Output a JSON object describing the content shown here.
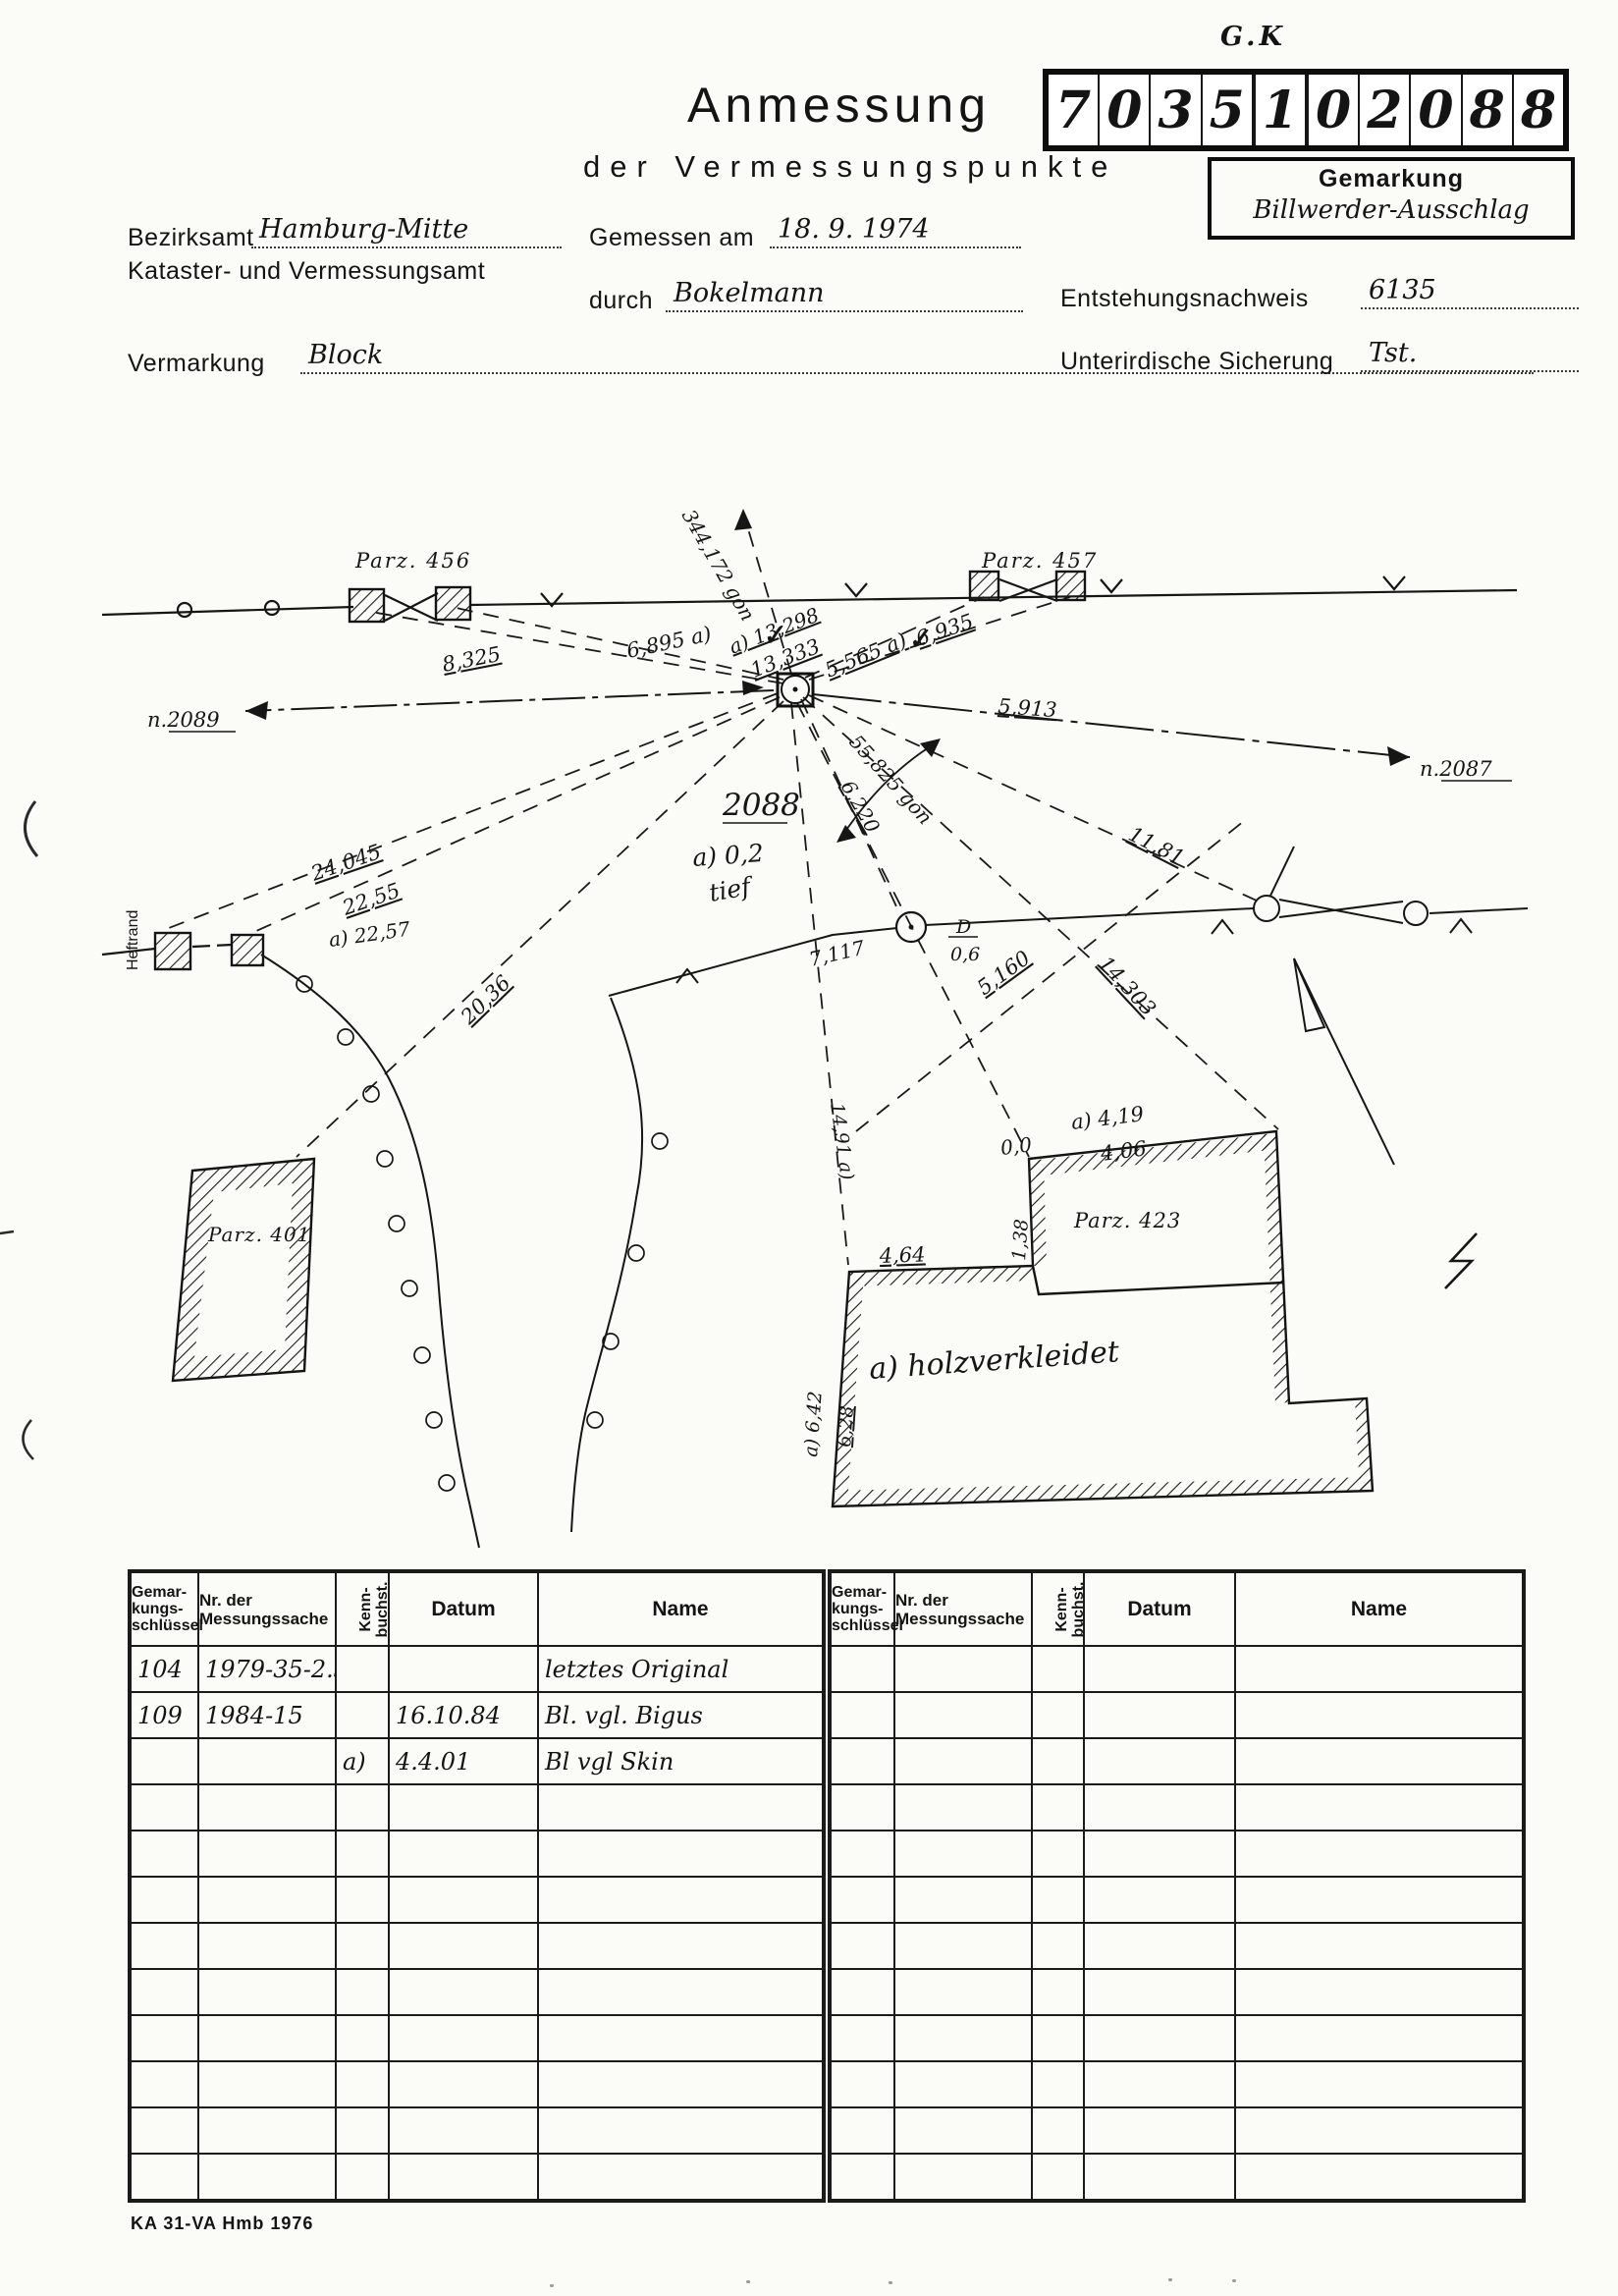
{
  "header": {
    "gk_note": "G.K",
    "title": "Anmessung",
    "subtitle": "der Vermessungspunkte",
    "point_number_digits": [
      "7",
      "0",
      "3",
      "5",
      "1",
      "0",
      "2",
      "0",
      "8",
      "8"
    ],
    "gemarkung_label": "Gemarkung",
    "gemarkung_value": "Billwerder-Ausschlag"
  },
  "form": {
    "bezirksamt_label": "Bezirksamt",
    "bezirksamt_value": "Hamburg-Mitte",
    "amt_line2": "Kataster- und Vermessungsamt",
    "gemessen_label": "Gemessen am",
    "gemessen_value": "18. 9. 1974",
    "durch_label": "durch",
    "durch_value": "Bokelmann",
    "entstehung_label": "Entstehungsnachweis",
    "entstehung_value": "6135",
    "vermarkung_label": "Vermarkung",
    "vermarkung_value": "Block",
    "sicherung_label": "Unterirdische Sicherung",
    "sicherung_value": "Tst."
  },
  "sketch": {
    "labels": {
      "parz456": "Parz. 456",
      "parz457": "Parz. 457",
      "parz401": "Parz. 401",
      "parz423": "Parz. 423",
      "n2089": "n.2089",
      "n2087": "n.2087",
      "point2088": "2088",
      "note_a02": "a) 0,2",
      "note_tief": "tief",
      "gon344": "344,172 gon",
      "gon55": "55,825 gon",
      "m8325": "8,325",
      "m6895": "6,895 a)",
      "m13298": "a) 13,298",
      "m13333": "13,333",
      "m5565": "5,565 a)",
      "m6935": "6,935",
      "m5913": "5,913",
      "m24045": "24,045",
      "m2255": "22,55",
      "m2257": "a) 22,57",
      "m2036": "20,36",
      "m6220": "6,220",
      "m5160": "5,160",
      "m1181": "11,81",
      "m7117": "7,117",
      "m14303": "14,303",
      "m1491": "14,91 a)",
      "m419": "a) 4,19",
      "m406": "4,06",
      "m00": "0,0",
      "m138": "1,38",
      "m464": "4,64",
      "m642": "a) 6,42",
      "m628": "6,28",
      "tree_d": "D",
      "tree_d_value": "0,6",
      "holz": "a) holzverkleidet",
      "heftrand": "Heftrand",
      "check": "✓"
    }
  },
  "tables": {
    "header": {
      "col1_lines": [
        "Gemar-",
        "kungs-",
        "schlüssel"
      ],
      "col2": "Nr. der Messungssache",
      "col3_lines": [
        "Kenn-",
        "buchst."
      ],
      "col4": "Datum",
      "col5": "Name"
    },
    "left": {
      "total_rows": 12,
      "rows": [
        {
          "g": "104",
          "nr": "1979-35-2.31",
          "k": "",
          "d": "",
          "n": "letztes  Original"
        },
        {
          "g": "109",
          "nr": "1984-15",
          "k": "",
          "d": "16.10.84",
          "n": "Bl. vgl. Bigus"
        },
        {
          "g": "",
          "nr": "",
          "k": "a)",
          "d": "4.4.01",
          "n": "Bl  vgl  Skin"
        }
      ]
    },
    "right": {
      "total_rows": 12,
      "rows": []
    }
  },
  "footer": {
    "text": "KA 31-VA Hmb 1976"
  }
}
